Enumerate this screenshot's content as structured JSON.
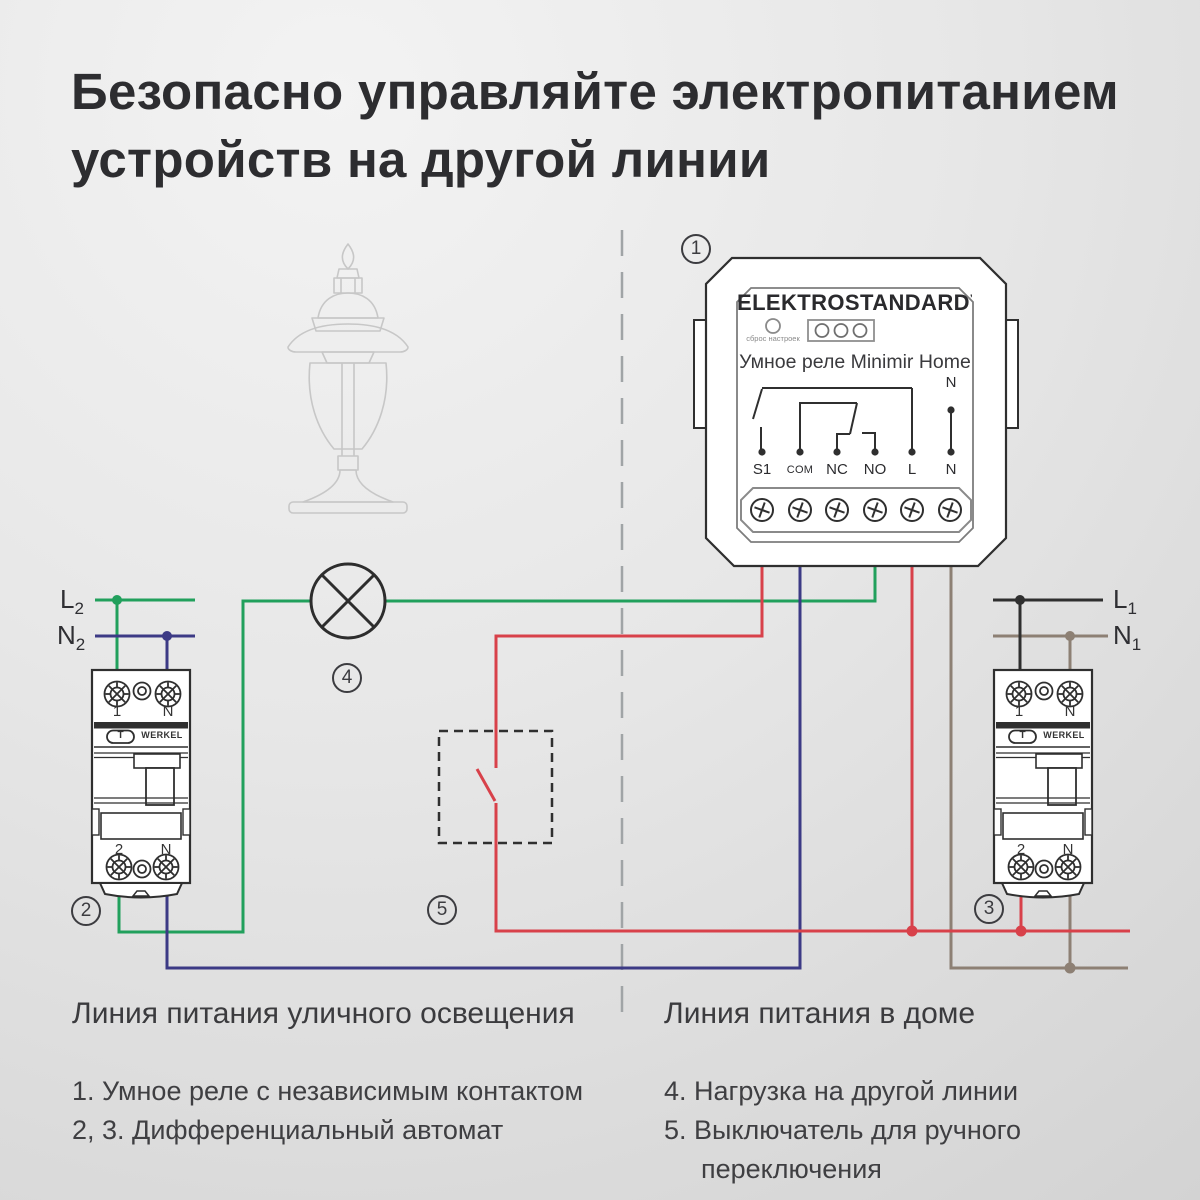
{
  "title": "Безопасно управляйте электропитанием устройств на другой линии",
  "relay": {
    "brand": "ELEKTROSTANDARD",
    "brand_mark": "’",
    "reset_label": "сброс настроек",
    "product_name": "Умное реле Minimir Home",
    "internal_n_label": "N",
    "terminals": [
      "S1",
      "COM",
      "NC",
      "NO",
      "L",
      "N"
    ]
  },
  "breaker": {
    "brand": "WERKEL",
    "test_button": "T",
    "top_terminal_1": "1",
    "top_terminal_n": "N",
    "bottom_terminal_2": "2",
    "bottom_terminal_n": "N"
  },
  "line_labels": {
    "left_live": "L",
    "left_live_sub": "2",
    "left_neutral": "N",
    "left_neutral_sub": "2",
    "right_live": "L",
    "right_live_sub": "1",
    "right_neutral": "N",
    "right_neutral_sub": "1"
  },
  "callouts": {
    "relay": "1",
    "breaker_left": "2",
    "breaker_right": "3",
    "load": "4",
    "switch": "5"
  },
  "captions": {
    "left": "Линия питания уличного освещения",
    "right": "Линия питания в доме"
  },
  "legend": {
    "left_line1": "1. Умное реле с независимым контактом",
    "left_line2": "2, 3. Дифференциальный автомат",
    "right_line1": "4. Нагрузка на другой линии",
    "right_line2": "5. Выключатель для ручного переключения"
  },
  "colors": {
    "live_street": "#21a05c",
    "neutral_street": "#3c3a85",
    "live_house": "#d8414a",
    "neutral_house": "#8d8074",
    "supply_black": "#2f2f2f"
  }
}
